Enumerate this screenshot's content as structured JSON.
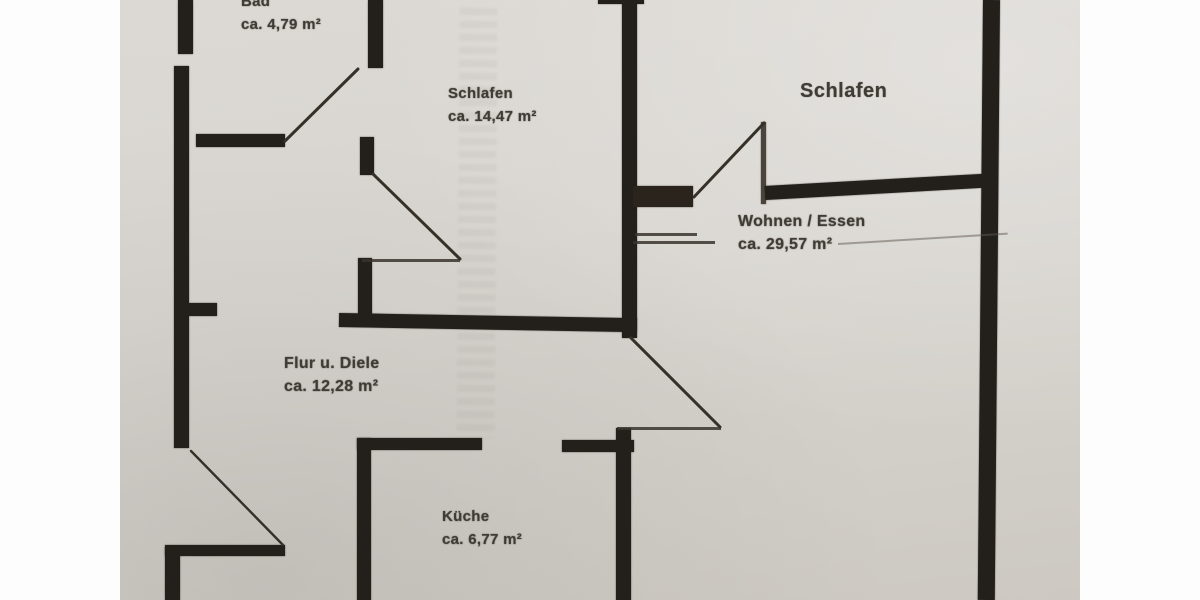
{
  "colors": {
    "paper": "#d8d5d0",
    "wall": "#23201b",
    "text": "#3f3b35",
    "letterbox": "#fdfdfd"
  },
  "rooms": [
    {
      "id": "bad",
      "name": "Bad",
      "area": "ca. 4,79 m²"
    },
    {
      "id": "schlafen_center",
      "name": "Schlafen",
      "area": "ca. 14,47 m²"
    },
    {
      "id": "schlafen_right",
      "name": "Schlafen",
      "area": ""
    },
    {
      "id": "wohnen_essen",
      "name": "Wohnen / Essen",
      "area": "ca. 29,57 m²"
    },
    {
      "id": "flur_diele",
      "name": "Flur u. Diele",
      "area": "ca. 12,28 m²"
    },
    {
      "id": "kueche",
      "name": "Küche",
      "area": "ca. 6,77 m²"
    }
  ]
}
